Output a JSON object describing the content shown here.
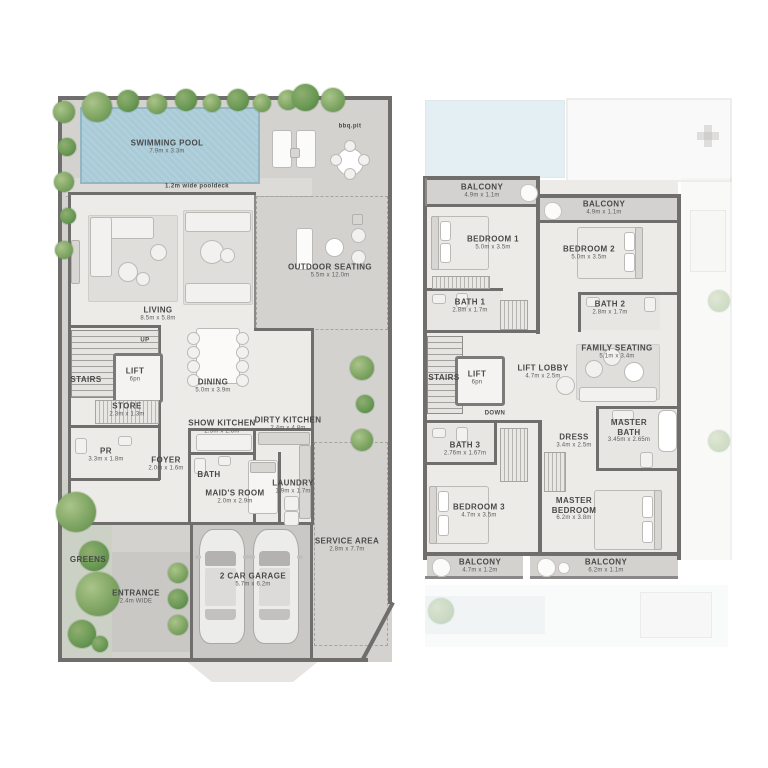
{
  "ground_floor": {
    "pool": {
      "name": "SWIMMING POOL",
      "dims": "7.9m x 3.3m"
    },
    "pooldeck": "1.2m wide pooldeck",
    "bbq": "bbq.pit",
    "outdoor_seating": {
      "name": "OUTDOOR SEATING",
      "dims": "5.5m x 12.0m"
    },
    "living": {
      "name": "LIVING",
      "dims": "8.5m x 5.8m"
    },
    "dining": {
      "name": "DINING",
      "dims": "5.0m x 3.9m"
    },
    "stairs": {
      "name": "STAIRS"
    },
    "up": "UP",
    "lift": {
      "name": "LIFT",
      "dims": "6pn"
    },
    "store": {
      "name": "STORE",
      "dims": "2.3m x 1.3m"
    },
    "pr": {
      "name": "PR",
      "dims": "3.3m x 1.8m"
    },
    "foyer": {
      "name": "FOYER",
      "dims": "2.0m x 1.6m"
    },
    "show_kitchen": {
      "name": "SHOW KITCHEN",
      "dims": "2.3m x 2.8m"
    },
    "dirty_kitchen": {
      "name": "DIRTY KITCHEN",
      "dims": "2.4m x 4.8m"
    },
    "bath": {
      "name": "BATH"
    },
    "maids_room": {
      "name": "MAID'S ROOM",
      "dims": "2.0m x 2.9m"
    },
    "laundry": {
      "name": "LAUNDRY",
      "dims": "1.9m x 1.7m"
    },
    "greens": "GREENS",
    "entrance": {
      "name": "ENTRANCE",
      "dims": "2.4m WIDE"
    },
    "garage": {
      "name": "2 CAR GARAGE",
      "dims": "5.7m x 6.2m"
    },
    "service_area": {
      "name": "SERVICE AREA",
      "dims": "2.8m x 7.7m"
    }
  },
  "first_floor": {
    "balcony_tl": {
      "name": "BALCONY",
      "dims": "4.9m x 1.1m"
    },
    "balcony_tr": {
      "name": "BALCONY",
      "dims": "4.9m x 1.1m"
    },
    "bedroom1": {
      "name": "BEDROOM 1",
      "dims": "5.0m x 3.5m"
    },
    "bedroom2": {
      "name": "BEDROOM 2",
      "dims": "5.0m x 3.5m"
    },
    "bath1": {
      "name": "BATH 1",
      "dims": "2.8m x 1.7m"
    },
    "bath2": {
      "name": "BATH 2",
      "dims": "2.8m x 1.7m"
    },
    "stairs": {
      "name": "STAIRS"
    },
    "lift": {
      "name": "LIFT",
      "dims": "6pn"
    },
    "lift_lobby": {
      "name": "LIFT LOBBY",
      "dims": "4.7m x 2.5m"
    },
    "family_seating": {
      "name": "FAMILY SEATING",
      "dims": "5.1m x 3.4m"
    },
    "down": "DOWN",
    "bath3": {
      "name": "BATH 3",
      "dims": "2.76m x 1.67m"
    },
    "dress": {
      "name": "DRESS",
      "dims": "3.4m x 2.5m"
    },
    "master_bath": {
      "name": "MASTER BATH",
      "dims": "3.45m x 2.65m"
    },
    "bedroom3": {
      "name": "BEDROOM 3",
      "dims": "4.7m x 3.5m"
    },
    "master_bedroom": {
      "name": "MASTER BEDROOM",
      "dims": "6.2m x 3.8m"
    },
    "balcony_bl": {
      "name": "BALCONY",
      "dims": "4.7m x 1.2m"
    },
    "balcony_br": {
      "name": "BALCONY",
      "dims": "6.2m x 1.1m"
    }
  }
}
